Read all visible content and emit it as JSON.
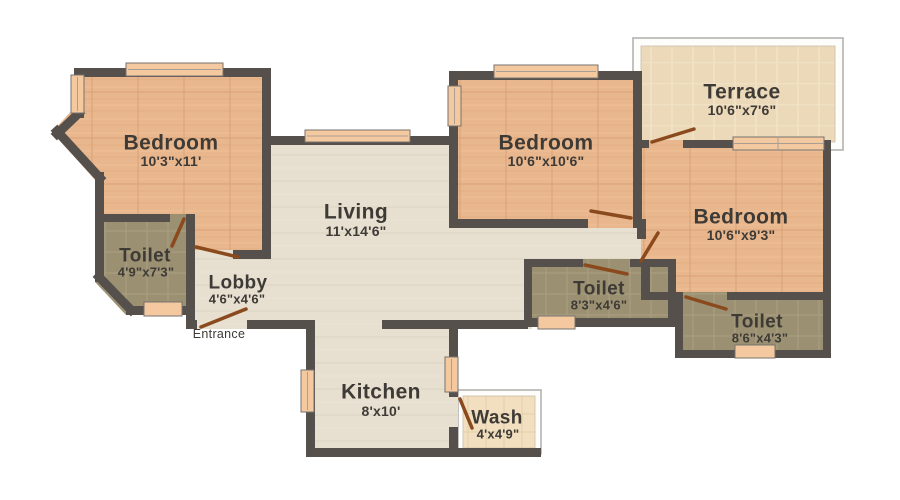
{
  "plan": {
    "rooms": [
      {
        "id": "bedroom-1",
        "name": "Bedroom",
        "dims": "10'3\"x11'"
      },
      {
        "id": "toilet-1",
        "name": "Toilet",
        "dims": "4'9\"x7'3\""
      },
      {
        "id": "lobby",
        "name": "Lobby",
        "dims": "4'6\"x4'6\""
      },
      {
        "id": "living",
        "name": "Living",
        "dims": "11'x14'6\""
      },
      {
        "id": "kitchen",
        "name": "Kitchen",
        "dims": "8'x10'"
      },
      {
        "id": "wash",
        "name": "Wash",
        "dims": "4'x4'9\""
      },
      {
        "id": "bedroom-2",
        "name": "Bedroom",
        "dims": "10'6\"x10'6\""
      },
      {
        "id": "terrace",
        "name": "Terrace",
        "dims": "10'6\"x7'6\""
      },
      {
        "id": "bedroom-3",
        "name": "Bedroom",
        "dims": "10'6\"x9'3\""
      },
      {
        "id": "toilet-2",
        "name": "Toilet",
        "dims": "8'3\"x4'6\""
      },
      {
        "id": "toilet-3",
        "name": "Toilet",
        "dims": "8'6\"x4'3\""
      }
    ],
    "annotations": {
      "entrance": "Entrance"
    },
    "colors": {
      "wall": "#55504c",
      "floor_bedroom": "#e9b78e",
      "floor_common": "#e7e0d1",
      "floor_toilet": "#9b9071",
      "floor_terrace": "#ecd9b9",
      "floor_wash": "#f1dfbf",
      "door": "#8b4a1e",
      "window": "#f5c9a0",
      "label_text": "#3e3a36"
    }
  }
}
